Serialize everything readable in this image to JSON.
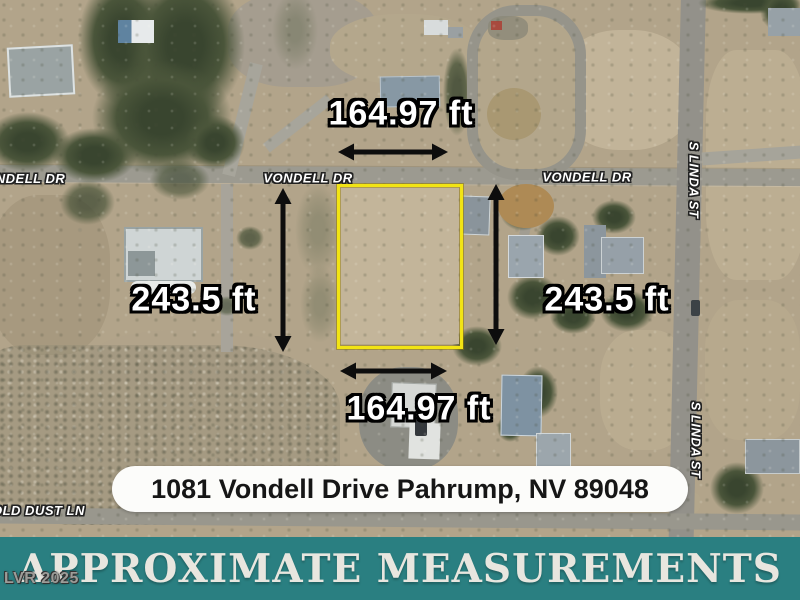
{
  "lot": {
    "width_label_top": "164.97 ft",
    "width_label_bottom": "164.97 ft",
    "height_label_left": "243.5 ft",
    "height_label_right": "243.5 ft"
  },
  "streets": {
    "vondell_left": "VONDELL DR",
    "vondell_center": "VONDELL DR",
    "vondell_right": "VONDELL DR",
    "s_linda_upper": "S LINDA ST",
    "s_linda_lower": "S LINDA ST",
    "old_dust": "OLD DUST LN"
  },
  "address": "1081 Vondell Drive Pahrump, NV 89048",
  "banner": "APPROXIMATE MEASUREMENTS",
  "watermark": "LVR 2025",
  "colors": {
    "lot_outline": "#f2e414",
    "banner_bg": "#2a7f81",
    "banner_text": "#e8e6df",
    "arrow": "#0d0d0d",
    "measurement_text": "#ffffff"
  }
}
